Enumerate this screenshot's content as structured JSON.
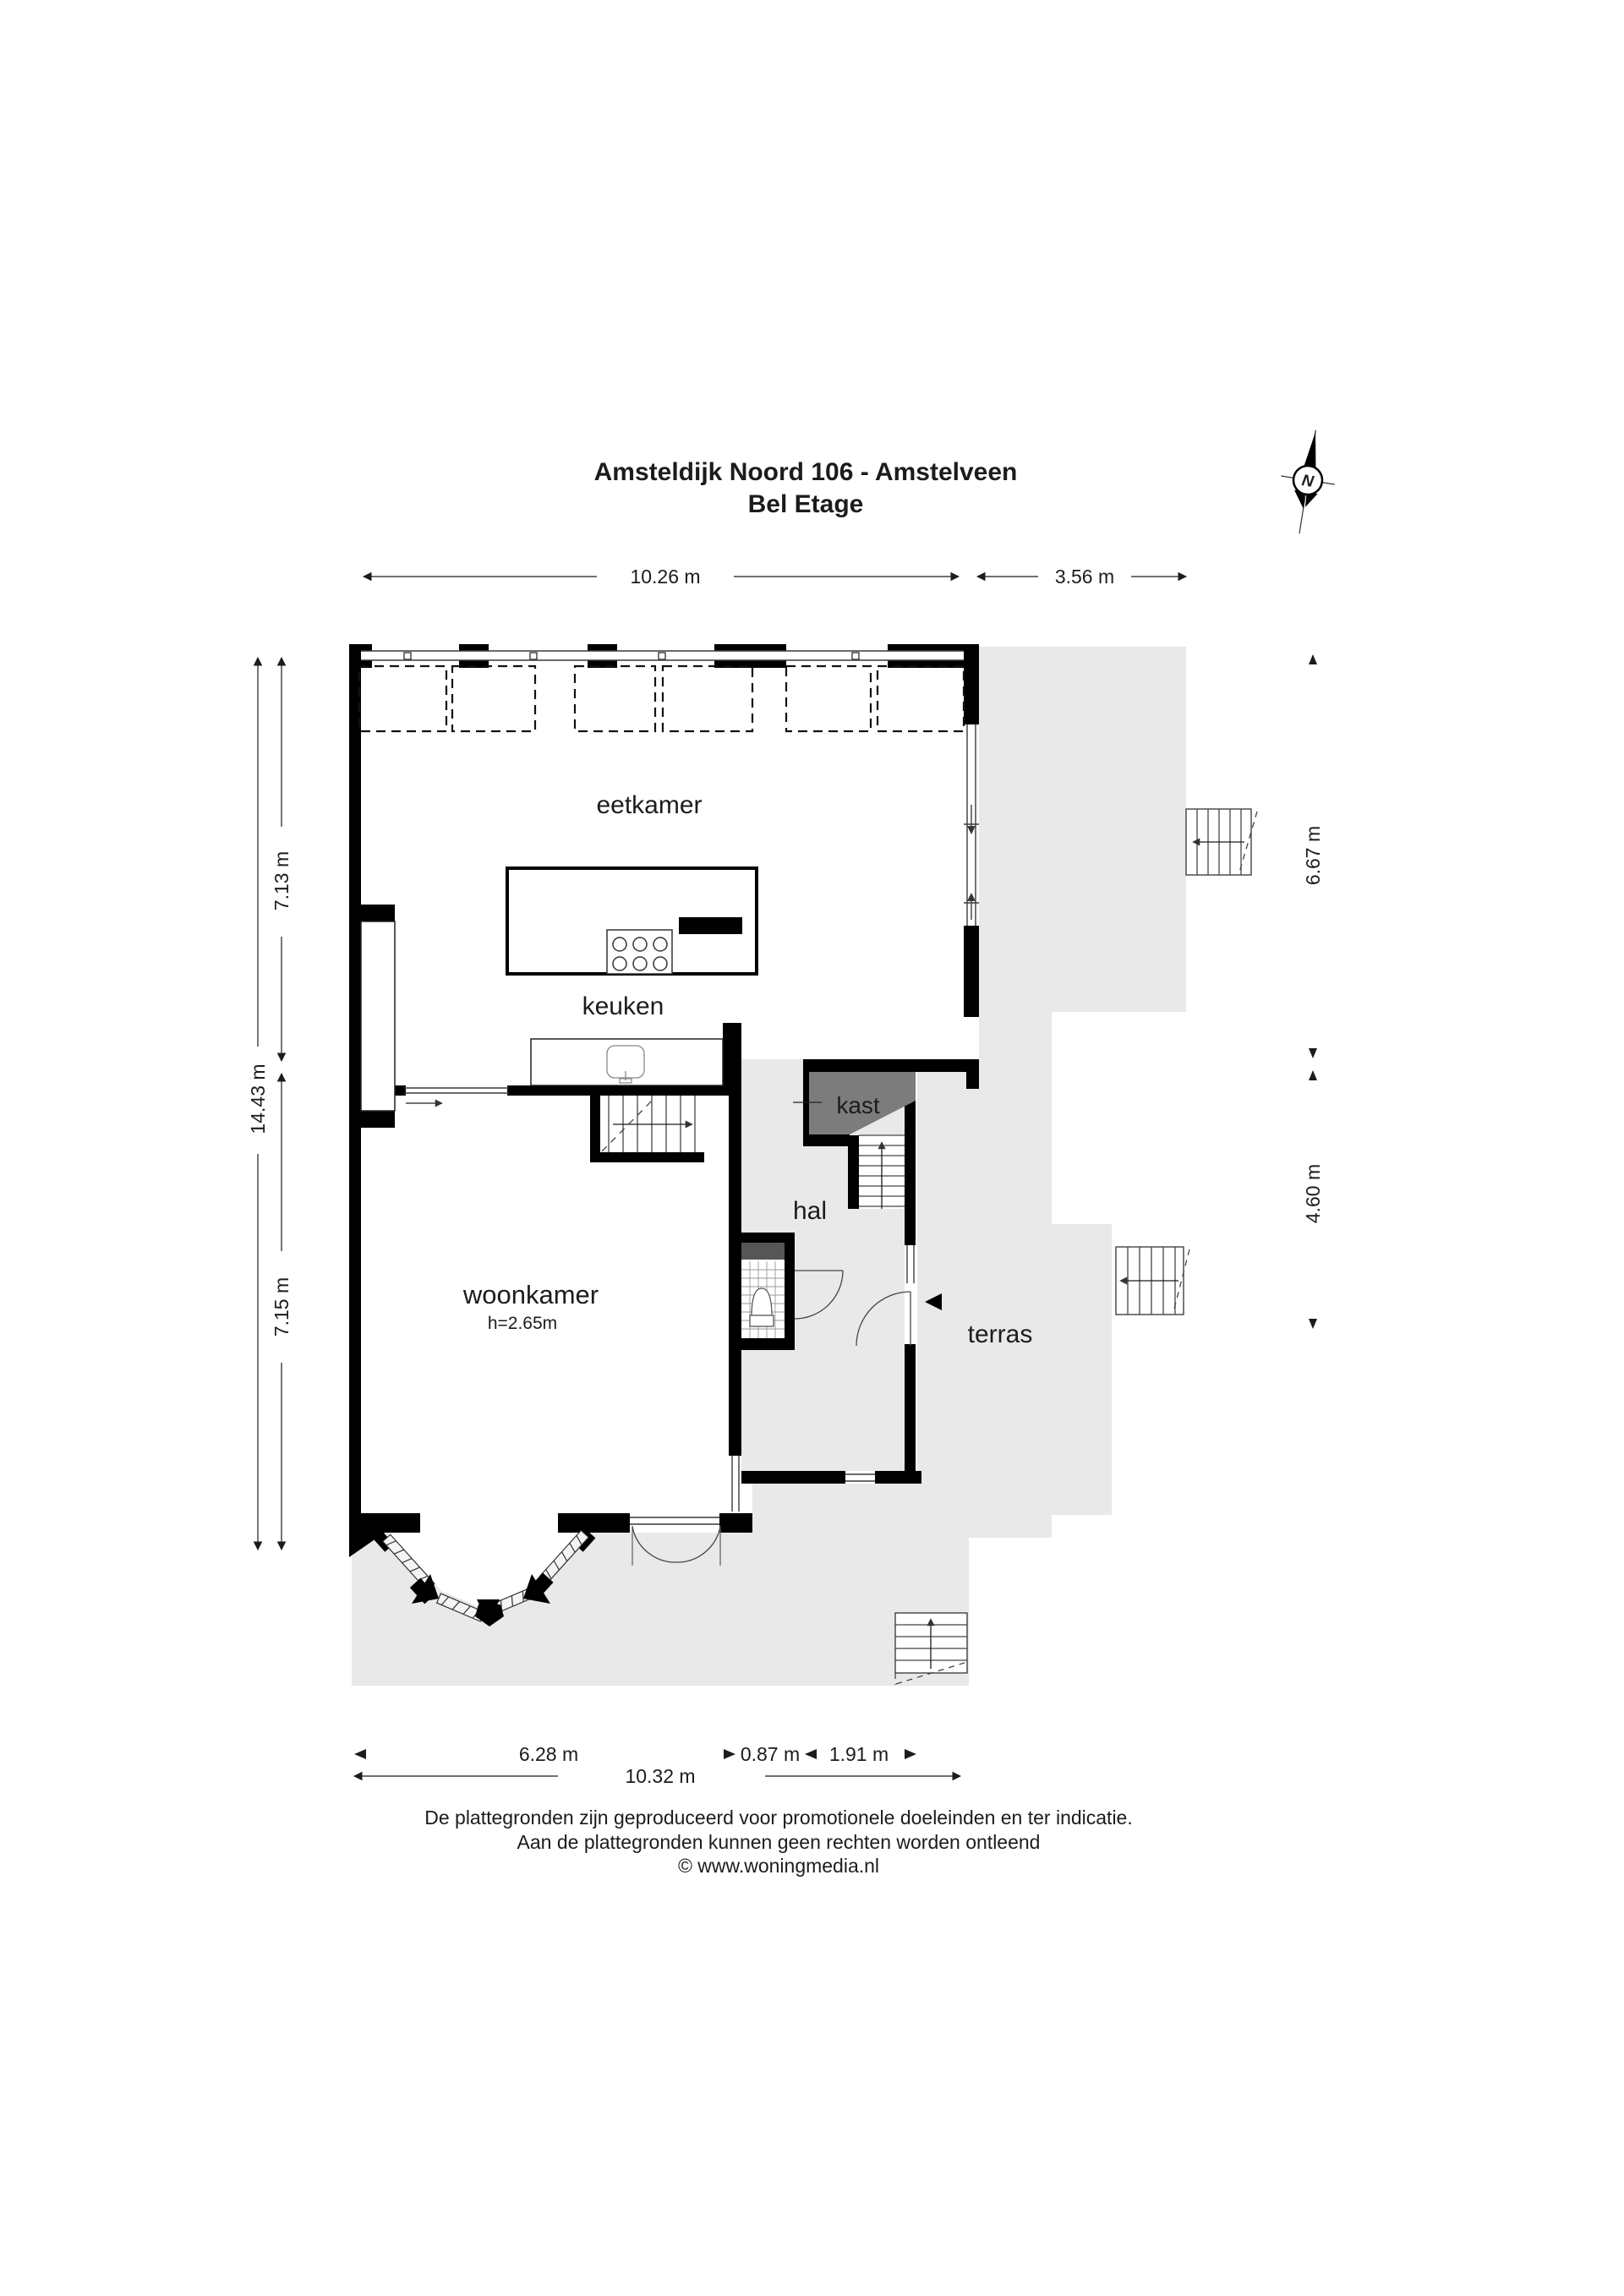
{
  "title": {
    "line1": "Amsteldijk Noord 106 - Amstelveen",
    "line2": "Bel Etage"
  },
  "compass": {
    "north_label": "N"
  },
  "rooms": {
    "eetkamer": {
      "label": "eetkamer"
    },
    "keuken": {
      "label": "keuken"
    },
    "kast": {
      "label": "kast"
    },
    "hal": {
      "label": "hal"
    },
    "woonkamer": {
      "label": "woonkamer",
      "ceiling_height": "h=2.65m"
    },
    "terras": {
      "label": "terras"
    }
  },
  "dimensions": {
    "top_main": "10.26 m",
    "top_right": "3.56 m",
    "left_total": "14.43 m",
    "left_upper": "7.13 m",
    "left_lower": "7.15 m",
    "right_upper": "6.67 m",
    "right_lower": "4.60 m",
    "bottom_left": "6.28 m",
    "bottom_mid": "0.87 m",
    "bottom_right": "1.91 m",
    "bottom_total": "10.32 m"
  },
  "footer": {
    "line1": "De plattegronden zijn geproduceerd voor promotionele doeleinden en ter indicatie.",
    "line2": "Aan de plattegronden kunnen geen rechten worden ontleend",
    "line3": "© www.woningmedia.nl"
  },
  "colors": {
    "wall": "#000000",
    "terrace": "#e9e9e9",
    "closet": "#7c7c7c",
    "shelf": "#565656",
    "text": "#1c1c1c"
  }
}
